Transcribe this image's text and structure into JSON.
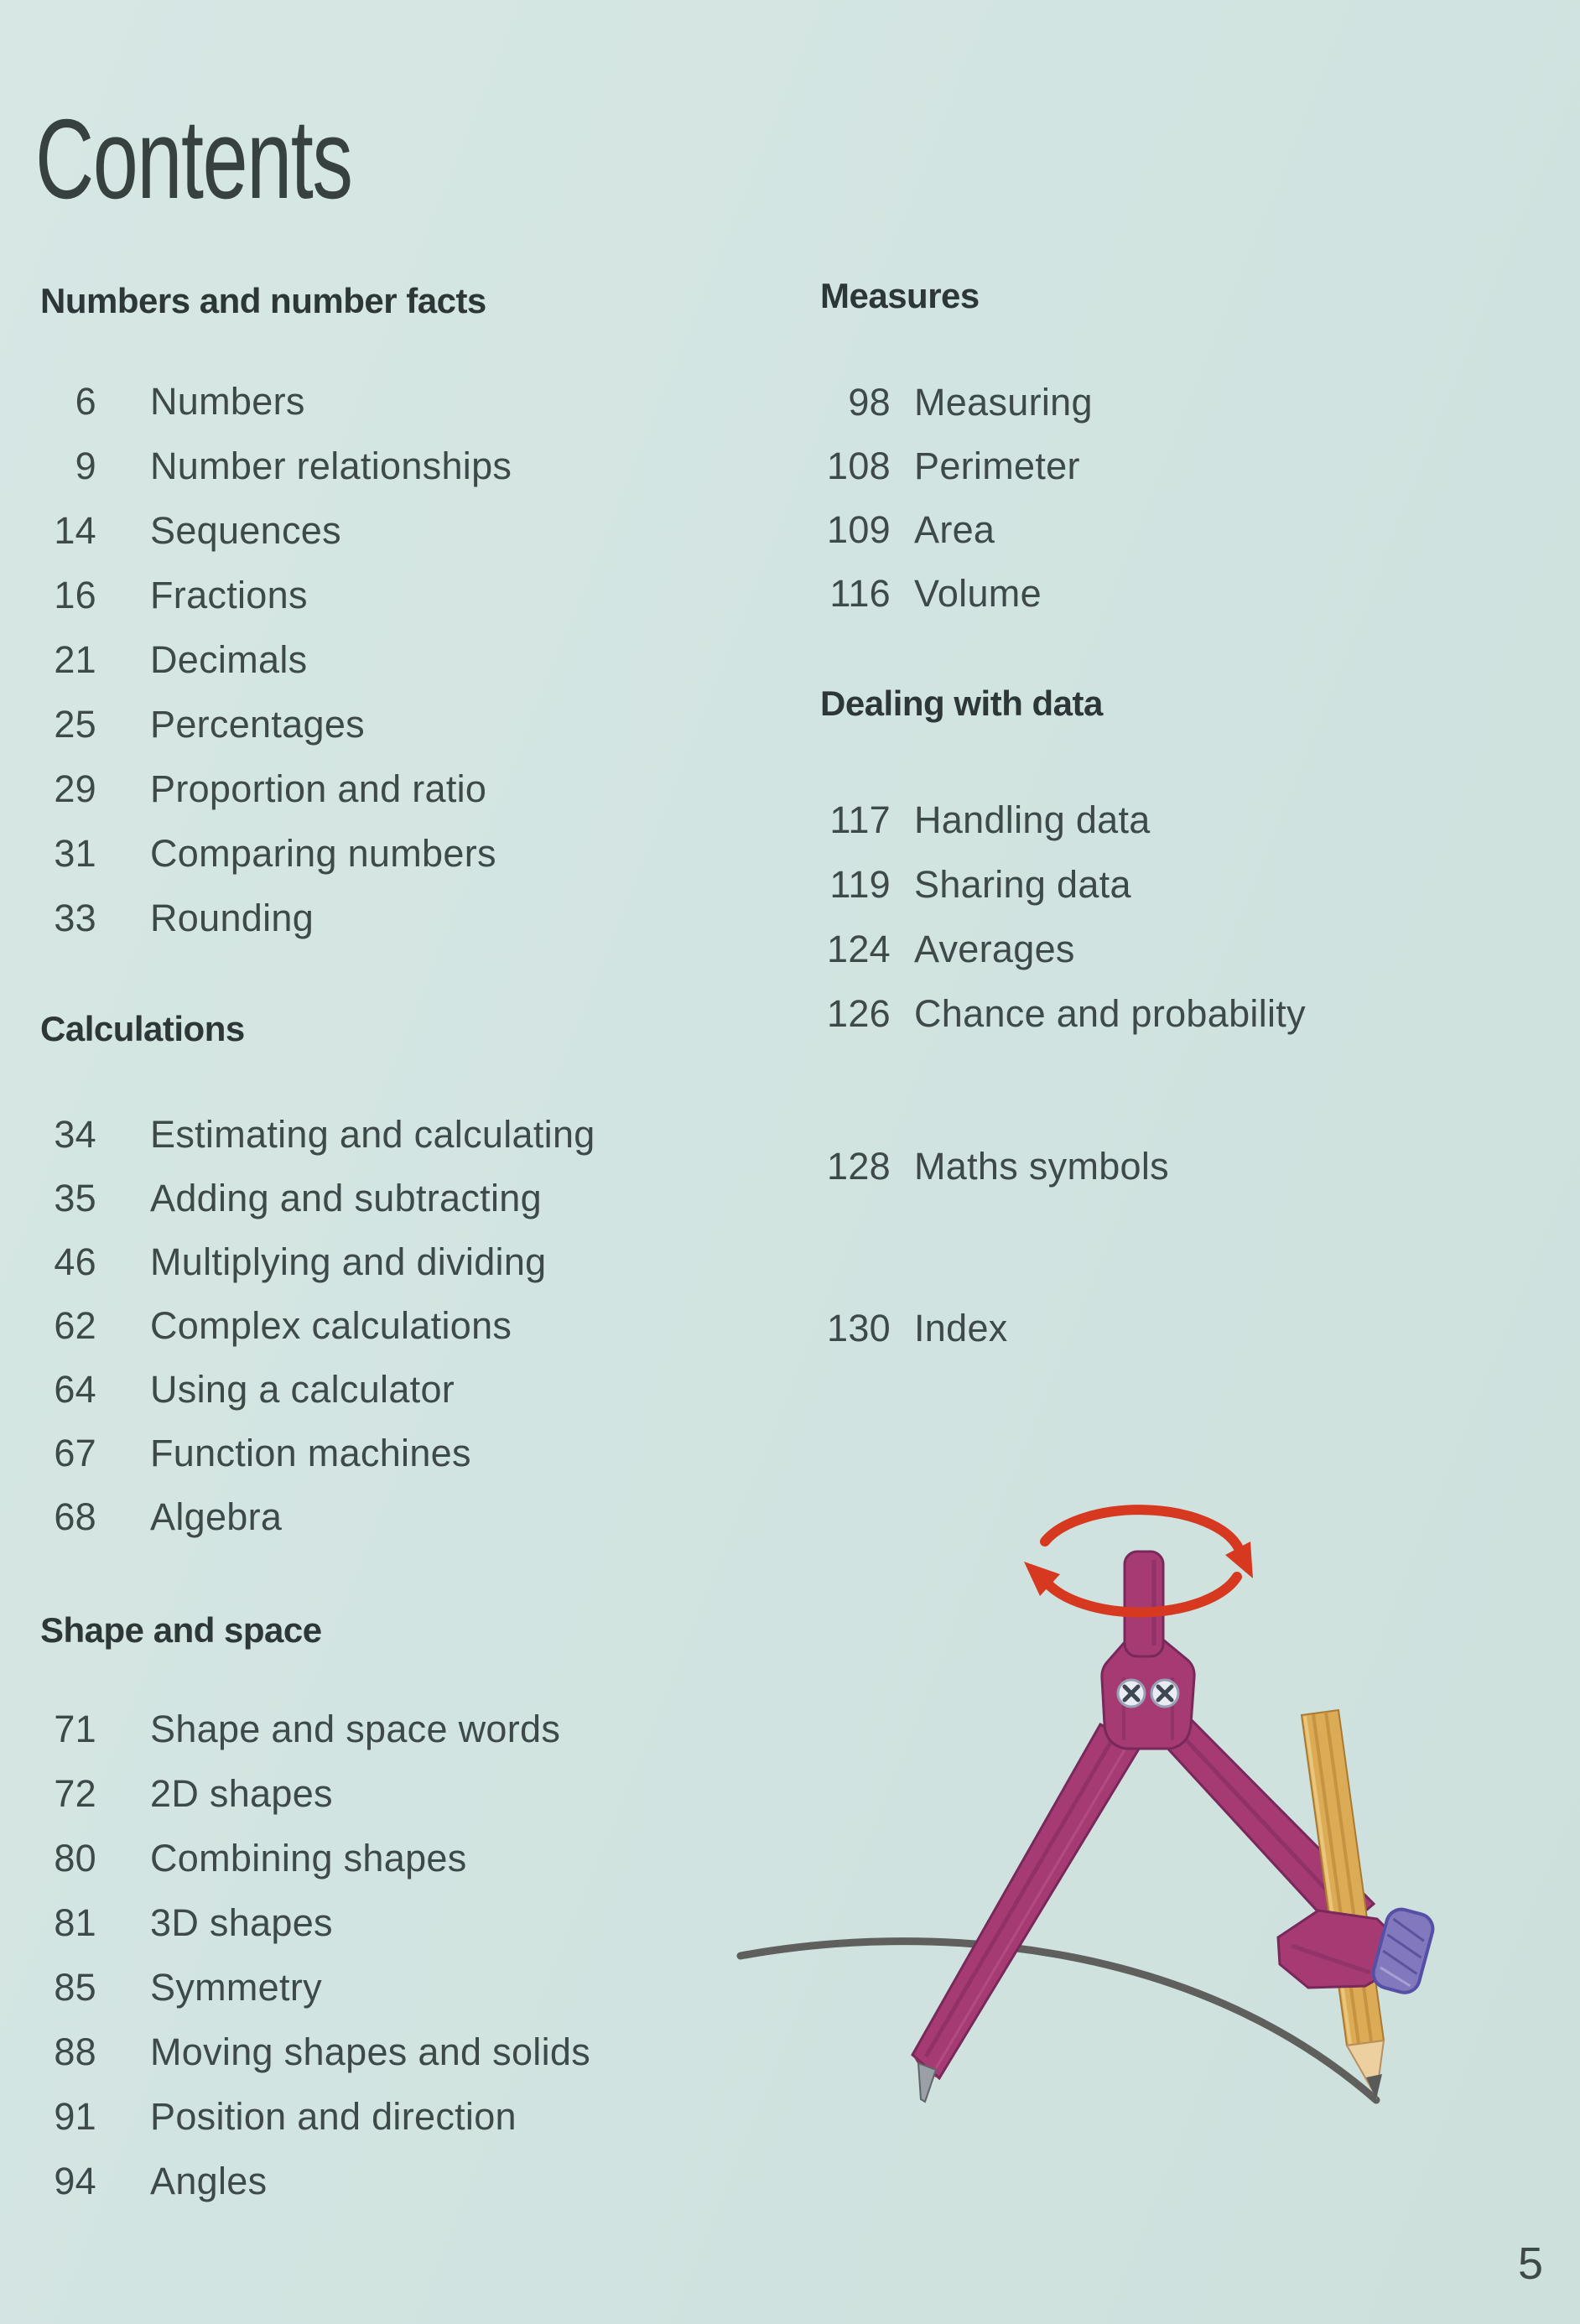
{
  "page": {
    "title": "Contents",
    "page_number": "5"
  },
  "colors": {
    "background": "#d2e4e1",
    "body_text": "#3e4949",
    "heading_text": "#2d3737",
    "accent_red": "#d6391f",
    "compass_magenta": "#a63b74",
    "pencil_yellow": "#dcab55",
    "arc_gray": "#5f5f5d"
  },
  "toc": {
    "left_sections": [
      {
        "heading": "Numbers and number facts",
        "entries": [
          {
            "page": "6",
            "label": "Numbers"
          },
          {
            "page": "9",
            "label": "Number relationships"
          },
          {
            "page": "14",
            "label": "Sequences"
          },
          {
            "page": "16",
            "label": "Fractions"
          },
          {
            "page": "21",
            "label": "Decimals"
          },
          {
            "page": "25",
            "label": "Percentages"
          },
          {
            "page": "29",
            "label": "Proportion and ratio"
          },
          {
            "page": "31",
            "label": "Comparing numbers"
          },
          {
            "page": "33",
            "label": "Rounding"
          }
        ]
      },
      {
        "heading": "Calculations",
        "entries": [
          {
            "page": "34",
            "label": "Estimating and calculating"
          },
          {
            "page": "35",
            "label": "Adding and subtracting"
          },
          {
            "page": "46",
            "label": "Multiplying and dividing"
          },
          {
            "page": "62",
            "label": "Complex calculations"
          },
          {
            "page": "64",
            "label": "Using a calculator"
          },
          {
            "page": "67",
            "label": "Function machines"
          },
          {
            "page": "68",
            "label": "Algebra"
          }
        ]
      },
      {
        "heading": "Shape and space",
        "entries": [
          {
            "page": "71",
            "label": "Shape and space words"
          },
          {
            "page": "72",
            "label": "2D shapes"
          },
          {
            "page": "80",
            "label": "Combining shapes"
          },
          {
            "page": "81",
            "label": "3D shapes"
          },
          {
            "page": "85",
            "label": "Symmetry"
          },
          {
            "page": "88",
            "label": "Moving shapes and solids"
          },
          {
            "page": "91",
            "label": "Position and direction"
          },
          {
            "page": "94",
            "label": "Angles"
          }
        ]
      }
    ],
    "right_sections": [
      {
        "heading": "Measures",
        "entries": [
          {
            "page": "98",
            "label": "Measuring"
          },
          {
            "page": "108",
            "label": "Perimeter"
          },
          {
            "page": "109",
            "label": "Area"
          },
          {
            "page": "116",
            "label": "Volume"
          }
        ]
      },
      {
        "heading": "Dealing with data",
        "entries": [
          {
            "page": "117",
            "label": "Handling data"
          },
          {
            "page": "119",
            "label": "Sharing data"
          },
          {
            "page": "124",
            "label": "Averages"
          },
          {
            "page": "126",
            "label": "Chance and probability"
          }
        ]
      }
    ],
    "right_standalone": [
      {
        "page": "128",
        "label": "Maths symbols"
      },
      {
        "page": "130",
        "label": "Index"
      }
    ]
  },
  "illustration": {
    "name": "compass-drawing-an-arc",
    "parts": [
      "rotation-arrow-icon",
      "compass",
      "pencil",
      "drawn-arc"
    ]
  }
}
